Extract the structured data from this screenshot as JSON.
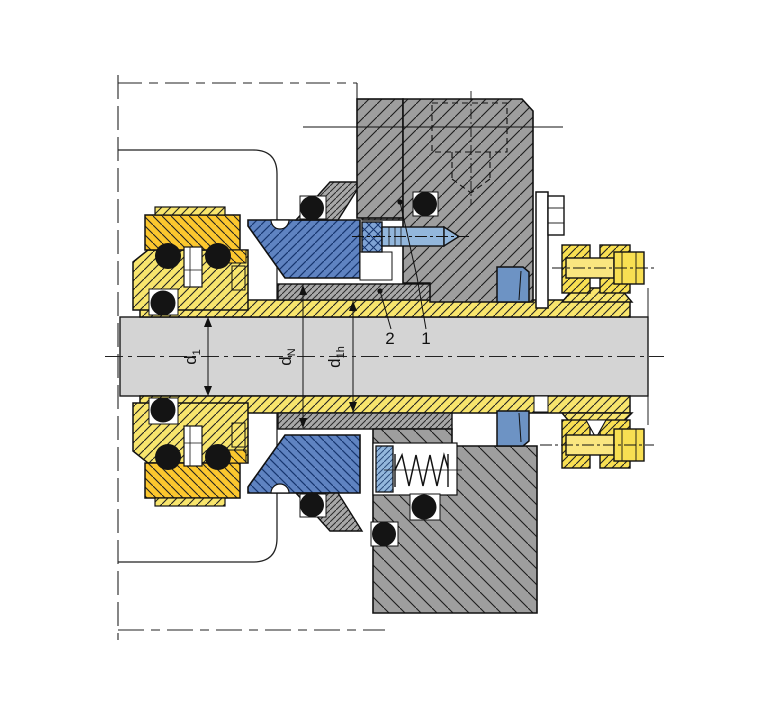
{
  "figure": {
    "kind": "mechanical-seal-cross-section",
    "description": "Sectional technical drawing of a cartridge mechanical shaft seal",
    "dimension_labels": [
      {
        "main": "d",
        "sub": "1"
      },
      {
        "main": "d",
        "sub": "N"
      },
      {
        "main": "d",
        "sub": "1h"
      }
    ],
    "callouts": [
      {
        "label": "2"
      },
      {
        "label": "1"
      }
    ],
    "colors": {
      "background": "#ffffff",
      "shaft_gray": "#d4d4d4",
      "housing_gray": "#9e9e9e",
      "adapter_gray": "#a8a8a8",
      "sleeve_yellow": "#f8e56d",
      "collar_gold": "#fcc72e",
      "bolt_yellow": "#f8df52",
      "seal_blue": "#5f83c1",
      "screw_light_blue": "#93b7dc",
      "wedge_steel_blue": "#6d93c4",
      "oring_black": "#141414",
      "line_black": "#000000"
    }
  }
}
